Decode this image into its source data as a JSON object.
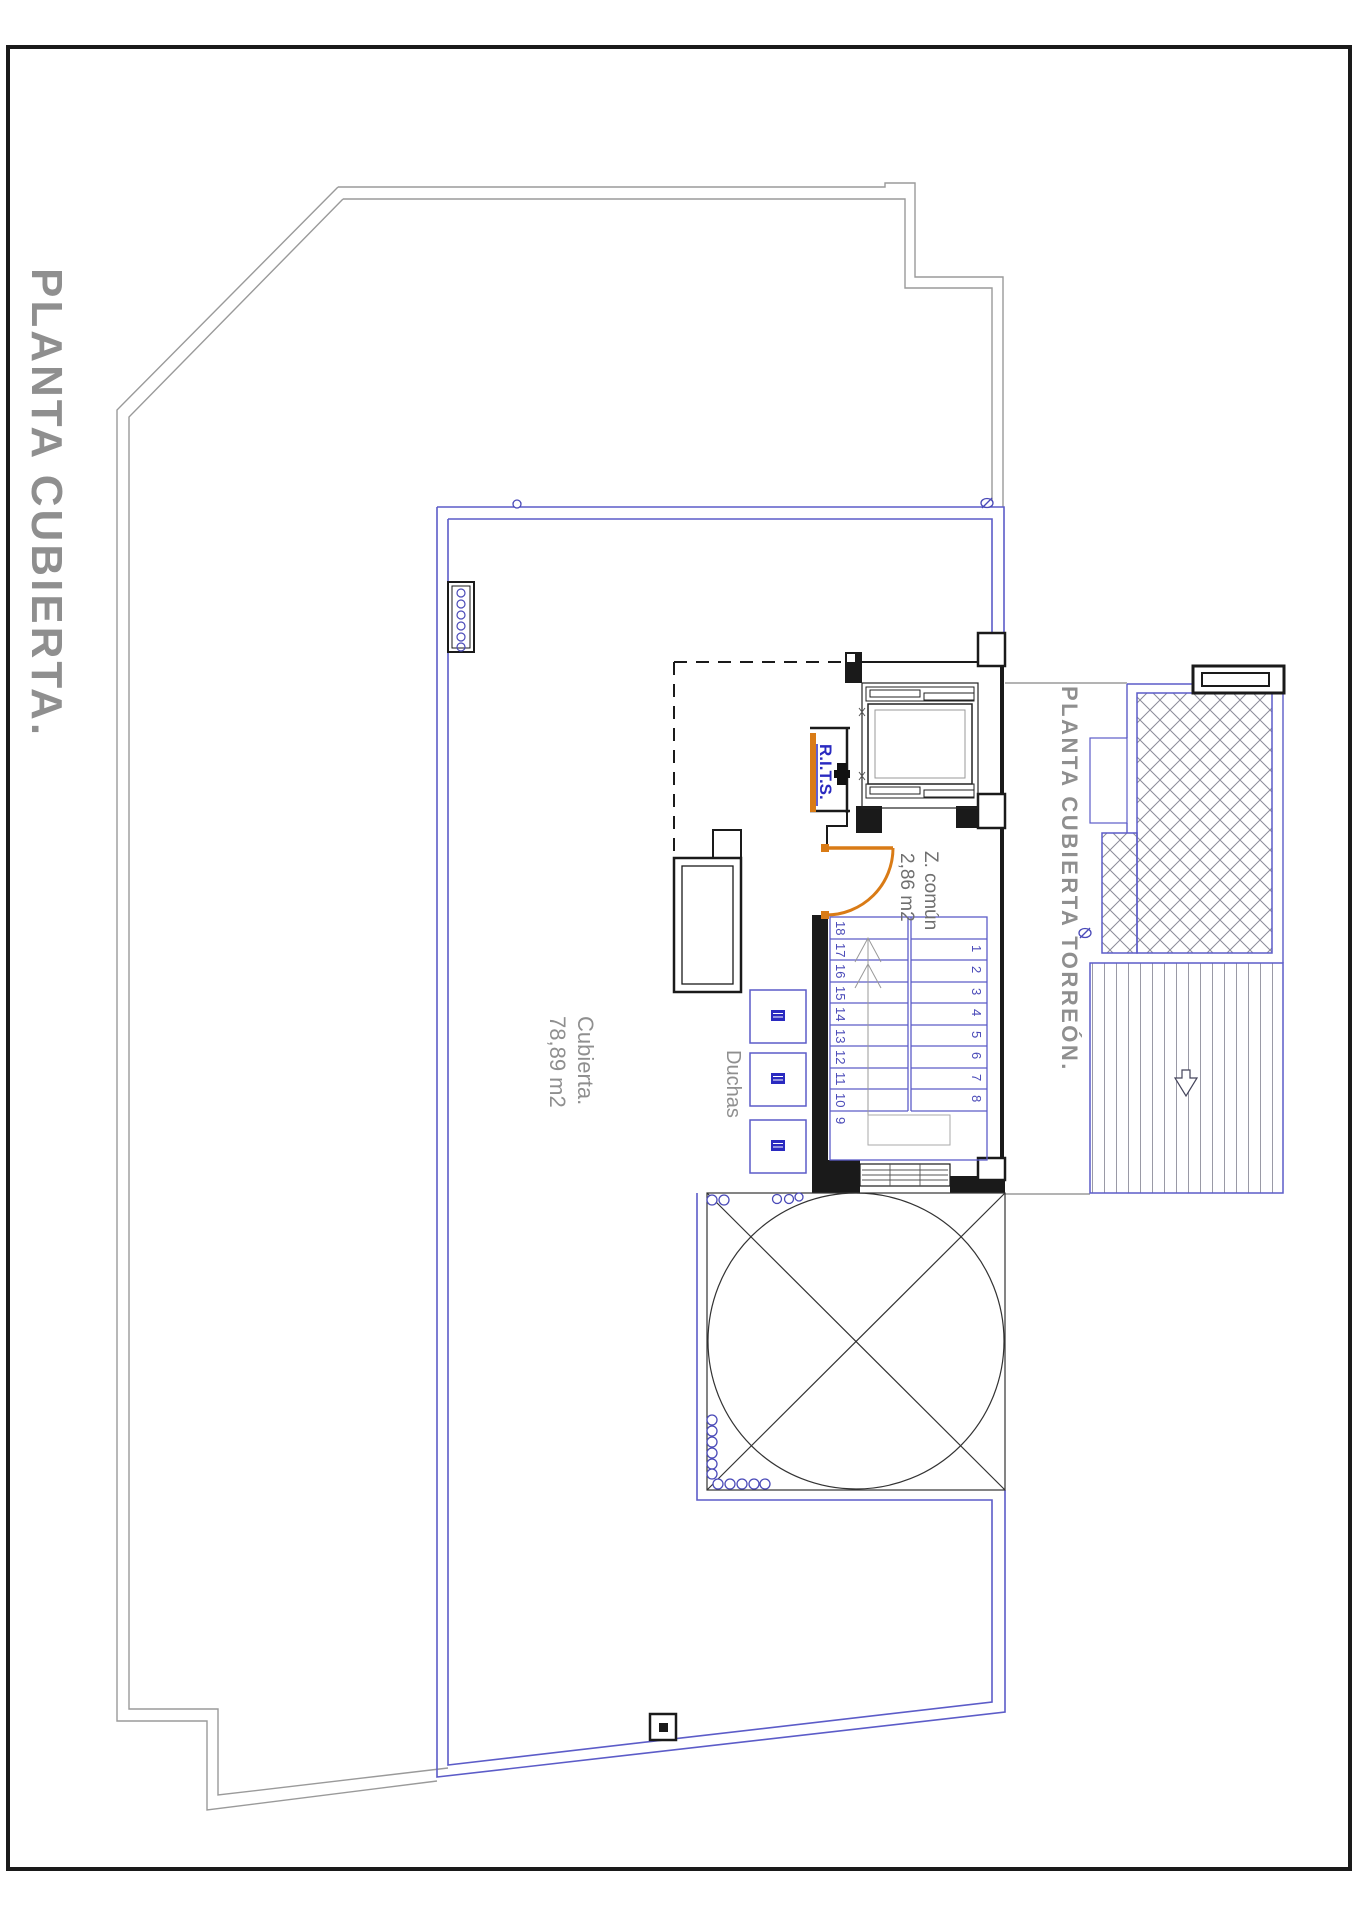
{
  "sheet": {
    "title": "PLANTA CUBIERTA."
  },
  "labels": {
    "main_title": "PLANTA CUBIERTA.",
    "torreon_title": "PLANTA CUBIERTA TORREÓN.",
    "roof_area_name": "Cubierta.",
    "roof_area_value": "78,89 m2",
    "common_zone_name": "Z. común",
    "common_zone_value": "2,86 m2",
    "showers": "Duchas",
    "telecom_room": "R.I.T.S."
  },
  "stairs": {
    "left_flight_numbers": [
      "18",
      "17",
      "16",
      "15",
      "14",
      "13",
      "12",
      "11",
      "10",
      "9"
    ],
    "right_flight_numbers": [
      "1",
      "2",
      "3",
      "4",
      "5",
      "6",
      "7",
      "8"
    ]
  },
  "colors": {
    "accent_orange": "#d97b16",
    "cad_blue": "#5c5cc8",
    "deep_blue": "#2a2ac0",
    "outline_gray": "#9a9a9a",
    "text_gray": "#8f8f8f",
    "wall_black": "#1a1a1a"
  }
}
